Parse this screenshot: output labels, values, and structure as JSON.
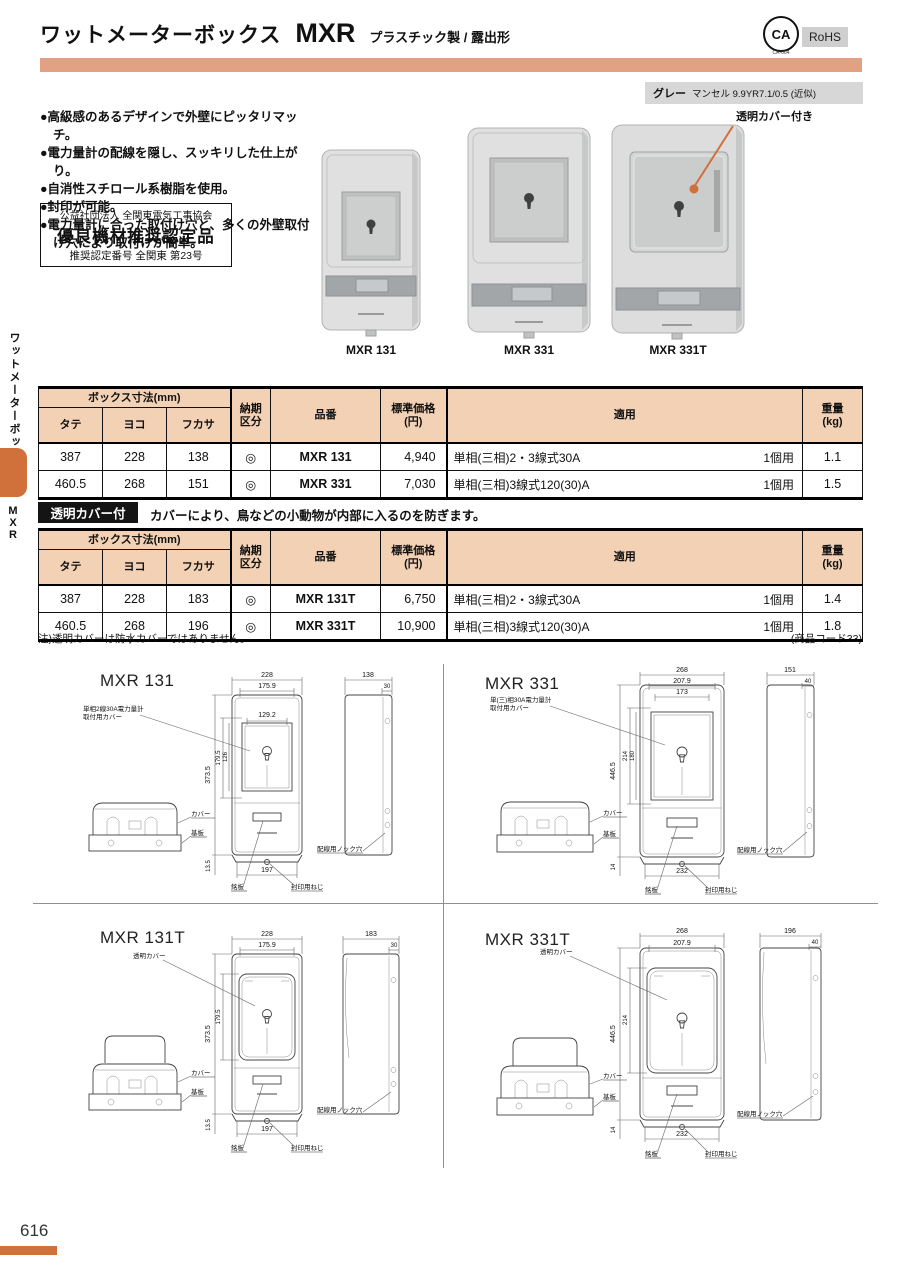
{
  "header": {
    "title": "ワットメーターボックス",
    "model": "MXR",
    "subtitle": "プラスチック製 / 露出形",
    "ca_label": "CA",
    "ca_code": "CA-004",
    "rohs_label": "RoHS",
    "color_name": "グレー",
    "color_value": "マンセル 9.9YR7.1/0.5 (近似)",
    "accent_color": "#E3A184",
    "orange_accent": "#D0703A"
  },
  "sidebar": {
    "category": "ワットメーターボックス",
    "model": "MXR"
  },
  "features": [
    "●高級感のあるデザインで外壁にピッタリマッチ。",
    "●電力量計の配線を隠し、スッキリした仕上がり。",
    "●自消性スチロール系樹脂を使用。",
    "●封印が可能。",
    "●電力量計に合った取付け穴と、多くの外壁取付け穴により取付けが簡単。"
  ],
  "certification": {
    "line1": "公益社団法人 全関東電気工事協会",
    "line2": "優良機材推奨認定品",
    "line3": "推奨認定番号 全関東 第23号"
  },
  "photos": {
    "labels": [
      "MXR 131",
      "MXR 331",
      "MXR 331T"
    ],
    "annotation": "透明カバー付き"
  },
  "table_headers": {
    "group": "ボックス寸法(mm)",
    "tate": "タテ",
    "yoko": "ヨコ",
    "fukasa": "フカサ",
    "delivery_l1": "納期",
    "delivery_l2": "区分",
    "part": "品番",
    "price_l1": "標準価格",
    "price_l2": "(円)",
    "apply": "適用",
    "weight_l1": "重量",
    "weight_l2": "(kg)"
  },
  "table1": {
    "rows": [
      {
        "tate": "387",
        "yoko": "228",
        "fukasa": "138",
        "delivery": "◎",
        "part": "MXR 131",
        "price": "4,940",
        "application": "単相(三相)2・3線式30A",
        "unit": "1個用",
        "weight": "1.1"
      },
      {
        "tate": "460.5",
        "yoko": "268",
        "fukasa": "151",
        "delivery": "◎",
        "part": "MXR 331",
        "price": "7,030",
        "application": "単相(三相)3線式120(30)A",
        "unit": "1個用",
        "weight": "1.5"
      }
    ]
  },
  "section2": {
    "badge": "透明カバー付",
    "description": "カバーにより、鳥などの小動物が内部に入るのを防ぎます。"
  },
  "table2": {
    "rows": [
      {
        "tate": "387",
        "yoko": "228",
        "fukasa": "183",
        "delivery": "◎",
        "part": "MXR 131T",
        "price": "6,750",
        "application": "単相(三相)2・3線式30A",
        "unit": "1個用",
        "weight": "1.4"
      },
      {
        "tate": "460.5",
        "yoko": "268",
        "fukasa": "196",
        "delivery": "◎",
        "part": "MXR 331T",
        "price": "10,900",
        "application": "単相(三相)3線式120(30)A",
        "unit": "1個用",
        "weight": "1.8"
      }
    ]
  },
  "notes": {
    "left": "注)透明カバーは防水カバーではありません。",
    "right": "(商品コード33)"
  },
  "drawings": [
    {
      "title": "MXR 131",
      "callout1_l1": "単相2線30A電力量計",
      "callout1_l2": "取付用カバー",
      "dims": {
        "w": "228",
        "iw": "175.9",
        "ww": "129.2",
        "h": "373.5",
        "wh": "179.5",
        "wh2": "126",
        "bw": "197",
        "bo": "13.5",
        "d": "138",
        "d2": "30"
      },
      "labels": {
        "cover": "カバー",
        "base": "基板",
        "knock": "配線用ノック穴",
        "plate": "銘板",
        "seal": "封印用ねじ"
      }
    },
    {
      "title": "MXR 331",
      "callout1_l1": "単(三)相30A電力量計",
      "callout1_l2": "取付用カバー",
      "dims": {
        "w": "268",
        "iw": "207.9",
        "ww": "173",
        "h": "446.5",
        "wh": "214",
        "wh2": "180",
        "bw": "232",
        "bo": "14",
        "d": "151",
        "d2": "40"
      },
      "labels": {
        "cover": "カバー",
        "base": "基板",
        "knock": "配線用ノック穴",
        "plate": "銘板",
        "seal": "封印用ねじ"
      }
    },
    {
      "title": "MXR 131T",
      "callout1_l1": "透明カバー",
      "callout1_l2": "",
      "dims": {
        "w": "228",
        "iw": "175.9",
        "h": "373.5",
        "wh": "179.5",
        "bw": "197",
        "bo": "13.5",
        "d": "183",
        "d2": "30"
      },
      "labels": {
        "cover": "カバー",
        "base": "基板",
        "knock": "配線用ノック穴",
        "plate": "銘板",
        "seal": "封印用ねじ"
      }
    },
    {
      "title": "MXR 331T",
      "callout1_l1": "透明カバー",
      "callout1_l2": "",
      "dims": {
        "w": "268",
        "iw": "207.9",
        "h": "446.5",
        "wh": "214",
        "bw": "232",
        "bo": "14",
        "d": "196",
        "d2": "40"
      },
      "labels": {
        "cover": "カバー",
        "base": "基板",
        "knock": "配線用ノック穴",
        "plate": "銘板",
        "seal": "封印用ねじ"
      }
    }
  ],
  "footer": {
    "page_number": "616"
  }
}
